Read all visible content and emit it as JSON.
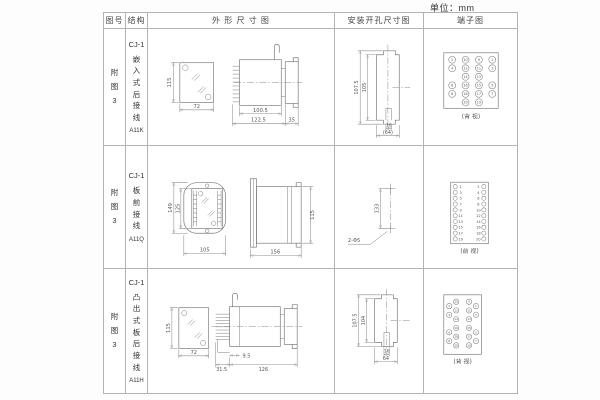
{
  "page": {
    "unit_label": "单位：mm"
  },
  "headers": {
    "fig": "图号",
    "structure": "结构",
    "outline": "外 形 尺 寸 图",
    "mounting": "安装开孔尺寸图",
    "terminal": "端子图"
  },
  "rows": [
    {
      "fig": "附\n图\n3",
      "series": "CJ-1",
      "structure": "嵌\n入\n式\n后\n接\n线",
      "model": "A11K",
      "outline": {
        "front_h": "115",
        "front_w": "72",
        "d1": "100.5",
        "d2": "122.5",
        "d3": "35"
      },
      "mounting": {
        "v1": "107.5",
        "v2": "105",
        "h1": "16",
        "h2": "(64)"
      },
      "terminal": {
        "view": "(背 视)",
        "grid": [
          [
            "2",
            "10",
            "9",
            "1"
          ],
          [
            "4",
            "12",
            "11",
            "3"
          ],
          [
            "",
            "14",
            "13",
            ""
          ],
          [
            "6",
            "16",
            "15",
            "5"
          ],
          [
            "8",
            "18",
            "17",
            "7"
          ],
          [
            "",
            "20",
            "19",
            ""
          ]
        ]
      }
    },
    {
      "fig": "附\n图\n3",
      "series": "CJ-1",
      "structure": "板\n前\n接\n线",
      "model": "A11Q",
      "outline": {
        "v1": "149",
        "v2": "125",
        "h1": "105",
        "h2": "156",
        "side_h": "115"
      },
      "mounting": {
        "v1": "133",
        "hole": "2-Φ5"
      },
      "terminal": {
        "view": "(前 视)",
        "left": [
          "1",
          "3",
          "5",
          "7",
          "9",
          "11",
          "13",
          "15",
          "17",
          "19"
        ],
        "right": [
          "2",
          "4",
          "6",
          "8",
          "10",
          "12",
          "14",
          "16",
          "18",
          "20"
        ]
      }
    },
    {
      "fig": "附\n图\n3",
      "series": "CJ-1",
      "structure": "凸\n出\n式\n板\n后\n接\n线",
      "model": "A11H",
      "outline": {
        "front_h": "115",
        "front_w": "72",
        "d1": "31.5",
        "d2": "9.5",
        "d3": "126"
      },
      "mounting": {
        "v1": "107.5",
        "v2": "104",
        "h1": "16",
        "h2": "64"
      },
      "terminal": {
        "view": "(背 视)",
        "grid": [
          [
            "2",
            "10",
            "9",
            "1"
          ],
          [
            "4",
            "12",
            "11",
            "3"
          ],
          [
            "",
            "14",
            "13",
            ""
          ],
          [
            "6",
            "16",
            "15",
            "5"
          ],
          [
            "8",
            "18",
            "17",
            "7"
          ],
          [
            "",
            "20",
            "19",
            ""
          ]
        ]
      }
    }
  ]
}
